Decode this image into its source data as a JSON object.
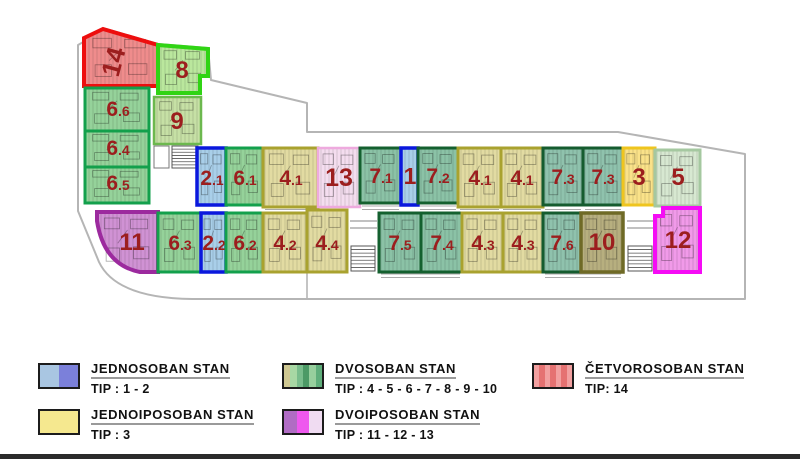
{
  "plan": {
    "outline_color": "#b5b5b5",
    "label_color": "#9c1e1e",
    "outline_path": "M78,211 L78,45 L106,29 L158,44 L208,48 L211,80 L307,103 L307,132 L618,132 L745,154 L745,299 L192,299 Q116,298 99,262 L78,211 Z",
    "units": [
      {
        "id": "14",
        "label": "14",
        "sub": "",
        "x": 84,
        "y": 33,
        "w": 74,
        "h": 53,
        "path": "M84,38 L103,29 L158,45 L158,86 L84,86 Z",
        "fill": "#ef8c8c",
        "stroke": "#ed0e0e",
        "sw": 4,
        "fs": 26,
        "lx": 122,
        "ly": 64,
        "rot": -75
      },
      {
        "id": "8",
        "label": "8",
        "sub": "",
        "x": 158,
        "y": 46,
        "w": 50,
        "h": 47,
        "path": "M158,45 L208,49 L208,76 L200,76 L200,93 L158,93 Z",
        "fill": "#bae79d",
        "stroke": "#30d414",
        "sw": 4,
        "fs": 24,
        "lx": 182,
        "ly": 78
      },
      {
        "id": "6.6",
        "label": "6",
        "sub": ".6",
        "x": 85,
        "y": 88,
        "w": 64,
        "h": 43,
        "fill": "#95d29a",
        "stroke": "#13a04c",
        "sw": 3,
        "fs": 21,
        "lx": 118,
        "ly": 116
      },
      {
        "id": "9",
        "label": "9",
        "sub": "",
        "x": 154,
        "y": 97,
        "w": 47,
        "h": 47,
        "fill": "#c6e0a5",
        "stroke": "#6cb84e",
        "sw": 2.5,
        "fs": 24,
        "lx": 177,
        "ly": 129
      },
      {
        "id": "6.4",
        "label": "6",
        "sub": ".4",
        "x": 85,
        "y": 131,
        "w": 64,
        "h": 36,
        "fill": "#95d29a",
        "stroke": "#13a04c",
        "sw": 3,
        "fs": 21,
        "lx": 118,
        "ly": 155
      },
      {
        "id": "6.5",
        "label": "6",
        "sub": ".5",
        "x": 85,
        "y": 167,
        "w": 64,
        "h": 36,
        "fill": "#95d29a",
        "stroke": "#13a04c",
        "sw": 3,
        "fs": 21,
        "lx": 118,
        "ly": 190
      },
      {
        "id": "11",
        "label": "11",
        "sub": "",
        "x": 97,
        "y": 212,
        "w": 61,
        "h": 60,
        "path": "M97,212 L158,212 L158,272 L140,272 Q104,265 97,221 Z",
        "fill": "#d092d4",
        "stroke": "#9c2a9e",
        "sw": 4,
        "fs": 24,
        "lx": 132,
        "ly": 250
      },
      {
        "id": "2.1",
        "label": "2",
        "sub": ".1",
        "x": 197,
        "y": 148,
        "w": 29,
        "h": 57,
        "fill": "#a9cfe9",
        "stroke": "#0a18dd",
        "sw": 3.5,
        "fs": 21,
        "lx": 212,
        "ly": 185
      },
      {
        "id": "6.1",
        "label": "6",
        "sub": ".1",
        "x": 226,
        "y": 148,
        "w": 37,
        "h": 57,
        "fill": "#95d29a",
        "stroke": "#13a04c",
        "sw": 3,
        "fs": 21,
        "lx": 245,
        "ly": 185
      },
      {
        "id": "4.1a",
        "label": "4",
        "sub": ".1",
        "x": 263,
        "y": 148,
        "w": 55,
        "h": 59,
        "fill": "#e2dba2",
        "stroke": "#a9a22f",
        "sw": 3,
        "fs": 21,
        "lx": 291,
        "ly": 185
      },
      {
        "id": "13",
        "label": "13",
        "sub": "",
        "x": 318,
        "y": 148,
        "w": 42,
        "h": 59,
        "fill": "#f4ddef",
        "stroke": "#eeaade",
        "sw": 2.5,
        "fs": 25,
        "lx": 339,
        "ly": 186
      },
      {
        "id": "7.1",
        "label": "7",
        "sub": ".1",
        "x": 360,
        "y": 148,
        "w": 41,
        "h": 55,
        "fill": "#8bc2a6",
        "stroke": "#14602f",
        "sw": 3,
        "fs": 21,
        "lx": 381,
        "ly": 183
      },
      {
        "id": "1",
        "label": "1",
        "sub": "",
        "x": 401,
        "y": 148,
        "w": 17,
        "h": 57,
        "fill": "#a9cfe9",
        "stroke": "#0a18dd",
        "sw": 3.5,
        "fs": 23,
        "lx": 410,
        "ly": 184
      },
      {
        "id": "7.2",
        "label": "7",
        "sub": ".2",
        "x": 418,
        "y": 148,
        "w": 40,
        "h": 55,
        "fill": "#8bc2a6",
        "stroke": "#14602f",
        "sw": 3,
        "fs": 21,
        "lx": 438,
        "ly": 183
      },
      {
        "id": "4.1b",
        "label": "4",
        "sub": ".1",
        "x": 458,
        "y": 148,
        "w": 43,
        "h": 59,
        "fill": "#e2dba2",
        "stroke": "#a9a22f",
        "sw": 3,
        "fs": 21,
        "lx": 480,
        "ly": 185
      },
      {
        "id": "4.1c",
        "label": "4",
        "sub": ".1",
        "x": 501,
        "y": 148,
        "w": 42,
        "h": 59,
        "fill": "#e2dba2",
        "stroke": "#a9a22f",
        "sw": 3,
        "fs": 21,
        "lx": 522,
        "ly": 185
      },
      {
        "id": "7.3a",
        "label": "7",
        "sub": ".3",
        "x": 543,
        "y": 148,
        "w": 40,
        "h": 57,
        "fill": "#8fc2ad",
        "stroke": "#155c2f",
        "sw": 3,
        "fs": 21,
        "lx": 563,
        "ly": 184
      },
      {
        "id": "7.3b",
        "label": "7",
        "sub": ".3",
        "x": 583,
        "y": 148,
        "w": 40,
        "h": 57,
        "fill": "#8fc2ad",
        "stroke": "#155c2f",
        "sw": 3,
        "fs": 21,
        "lx": 603,
        "ly": 184
      },
      {
        "id": "3",
        "label": "3",
        "sub": "",
        "x": 623,
        "y": 148,
        "w": 32,
        "h": 57,
        "fill": "#fae289",
        "stroke": "#efc51e",
        "sw": 3,
        "fs": 24,
        "lx": 639,
        "ly": 185
      },
      {
        "id": "5",
        "label": "5",
        "sub": "",
        "x": 655,
        "y": 150,
        "w": 45,
        "h": 56,
        "fill": "#d7e8d1",
        "stroke": "#a5c8a0",
        "sw": 3,
        "fs": 24,
        "lx": 678,
        "ly": 185
      },
      {
        "id": "6.3",
        "label": "6",
        "sub": ".3",
        "x": 158,
        "y": 213,
        "w": 43,
        "h": 59,
        "fill": "#95d29a",
        "stroke": "#13a04c",
        "sw": 3,
        "fs": 21,
        "lx": 180,
        "ly": 250
      },
      {
        "id": "2.2",
        "label": "2",
        "sub": ".2",
        "x": 201,
        "y": 213,
        "w": 25,
        "h": 59,
        "fill": "#a9cfe9",
        "stroke": "#0a18dd",
        "sw": 3.5,
        "fs": 21,
        "lx": 214,
        "ly": 250
      },
      {
        "id": "6.2",
        "label": "6",
        "sub": ".2",
        "x": 226,
        "y": 213,
        "w": 37,
        "h": 59,
        "fill": "#95d29a",
        "stroke": "#13a04c",
        "sw": 3,
        "fs": 21,
        "lx": 245,
        "ly": 250
      },
      {
        "id": "4.2",
        "label": "4",
        "sub": ".2",
        "x": 263,
        "y": 213,
        "w": 44,
        "h": 59,
        "fill": "#e2dba2",
        "stroke": "#a9a22f",
        "sw": 3,
        "fs": 21,
        "lx": 285,
        "ly": 250
      },
      {
        "id": "4.4",
        "label": "4",
        "sub": ".4",
        "x": 307,
        "y": 210,
        "w": 40,
        "h": 62,
        "fill": "#e2dba2",
        "stroke": "#a9a22f",
        "sw": 3,
        "fs": 21,
        "lx": 327,
        "ly": 250
      },
      {
        "id": "7.5",
        "label": "7",
        "sub": ".5",
        "x": 379,
        "y": 213,
        "w": 42,
        "h": 59,
        "fill": "#8bc2a6",
        "stroke": "#14602f",
        "sw": 3,
        "fs": 21,
        "lx": 400,
        "ly": 250
      },
      {
        "id": "7.4",
        "label": "7",
        "sub": ".4",
        "x": 421,
        "y": 213,
        "w": 41,
        "h": 59,
        "fill": "#8bc2a6",
        "stroke": "#14602f",
        "sw": 3,
        "fs": 21,
        "lx": 442,
        "ly": 250
      },
      {
        "id": "4.3a",
        "label": "4",
        "sub": ".3",
        "x": 462,
        "y": 213,
        "w": 41,
        "h": 59,
        "fill": "#e2dba2",
        "stroke": "#a9a22f",
        "sw": 3,
        "fs": 21,
        "lx": 483,
        "ly": 250
      },
      {
        "id": "4.3b",
        "label": "4",
        "sub": ".3",
        "x": 503,
        "y": 213,
        "w": 40,
        "h": 59,
        "fill": "#e2dba2",
        "stroke": "#a9a22f",
        "sw": 3,
        "fs": 21,
        "lx": 523,
        "ly": 250
      },
      {
        "id": "7.6",
        "label": "7",
        "sub": ".6",
        "x": 543,
        "y": 213,
        "w": 38,
        "h": 59,
        "fill": "#8fc2ad",
        "stroke": "#155c2f",
        "sw": 3,
        "fs": 21,
        "lx": 562,
        "ly": 250
      },
      {
        "id": "10",
        "label": "10",
        "sub": "",
        "x": 581,
        "y": 213,
        "w": 42,
        "h": 59,
        "fill": "#b7af7f",
        "stroke": "#6f6a26",
        "sw": 3.5,
        "fs": 24,
        "lx": 602,
        "ly": 250
      },
      {
        "id": "12",
        "label": "12",
        "sub": "",
        "x": 655,
        "y": 208,
        "w": 45,
        "h": 64,
        "path": "M655,216 L663,216 L663,208 L700,208 L700,272 L655,272 Z",
        "fill": "#f19ae9",
        "stroke": "#f50cf5",
        "sw": 4,
        "fs": 24,
        "lx": 678,
        "ly": 248
      }
    ],
    "stairs": [
      {
        "x": 172,
        "y": 146,
        "w": 26,
        "h": 22,
        "rungs": 7
      },
      {
        "x": 351,
        "y": 246,
        "w": 24,
        "h": 25,
        "rungs": 7
      },
      {
        "x": 628,
        "y": 246,
        "w": 24,
        "h": 25,
        "rungs": 7
      }
    ],
    "elevators": [
      {
        "x": 154,
        "y": 146,
        "w": 15,
        "h": 22
      }
    ],
    "deco_lines": [
      {
        "x1": 350,
        "y1": 221,
        "x2": 377,
        "y2": 221
      },
      {
        "x1": 350,
        "y1": 228,
        "x2": 377,
        "y2": 228
      },
      {
        "x1": 627,
        "y1": 221,
        "x2": 653,
        "y2": 221
      },
      {
        "x1": 627,
        "y1": 228,
        "x2": 653,
        "y2": 228
      },
      {
        "x1": 307,
        "y1": 272,
        "x2": 307,
        "y2": 298
      }
    ],
    "rails": [
      {
        "x": 265,
        "y": 206,
        "w": 51
      },
      {
        "x": 362,
        "y": 206,
        "w": 37
      },
      {
        "x": 420,
        "y": 206,
        "w": 36
      },
      {
        "x": 460,
        "y": 206,
        "w": 39
      },
      {
        "x": 503,
        "y": 206,
        "w": 38
      },
      {
        "x": 545,
        "y": 206,
        "w": 36
      },
      {
        "x": 585,
        "y": 206,
        "w": 36
      },
      {
        "x": 381,
        "y": 274,
        "w": 79
      },
      {
        "x": 545,
        "y": 274,
        "w": 76
      }
    ]
  },
  "legend": {
    "items": [
      {
        "title": "JEDNOSOBAN STAN",
        "tip": "TIP : 1 - 2",
        "swatch": [
          "#a9c6e2",
          "#7b80da"
        ]
      },
      {
        "title": "JEDNOIPOSOBAN STAN",
        "tip": "TIP : 3",
        "swatch": [
          "#f5e88f"
        ]
      },
      {
        "title": "DVOSOBAN STAN",
        "tip": "TIP : 4 - 5 - 6 - 7 - 8 - 9 - 10",
        "swatch": [
          "#cfc892",
          "#a8d8a4",
          "#79bd8c",
          "#4c9a66",
          "#97cf9d",
          "#5fae7b"
        ]
      },
      {
        "title": "DVOIPOSOBAN STAN",
        "tip": "TIP : 11 - 12 - 13",
        "swatch": [
          "#b06cc4",
          "#ee58ee",
          "#f0dcf2"
        ]
      },
      {
        "title": "ČETVOROSOBAN STAN",
        "tip": "TIP: 14",
        "swatch": [
          "#f2a0a0",
          "#e57272",
          "#f2a0a0",
          "#e57272",
          "#f2a0a0",
          "#e57272",
          "#f2a0a0"
        ]
      }
    ]
  }
}
